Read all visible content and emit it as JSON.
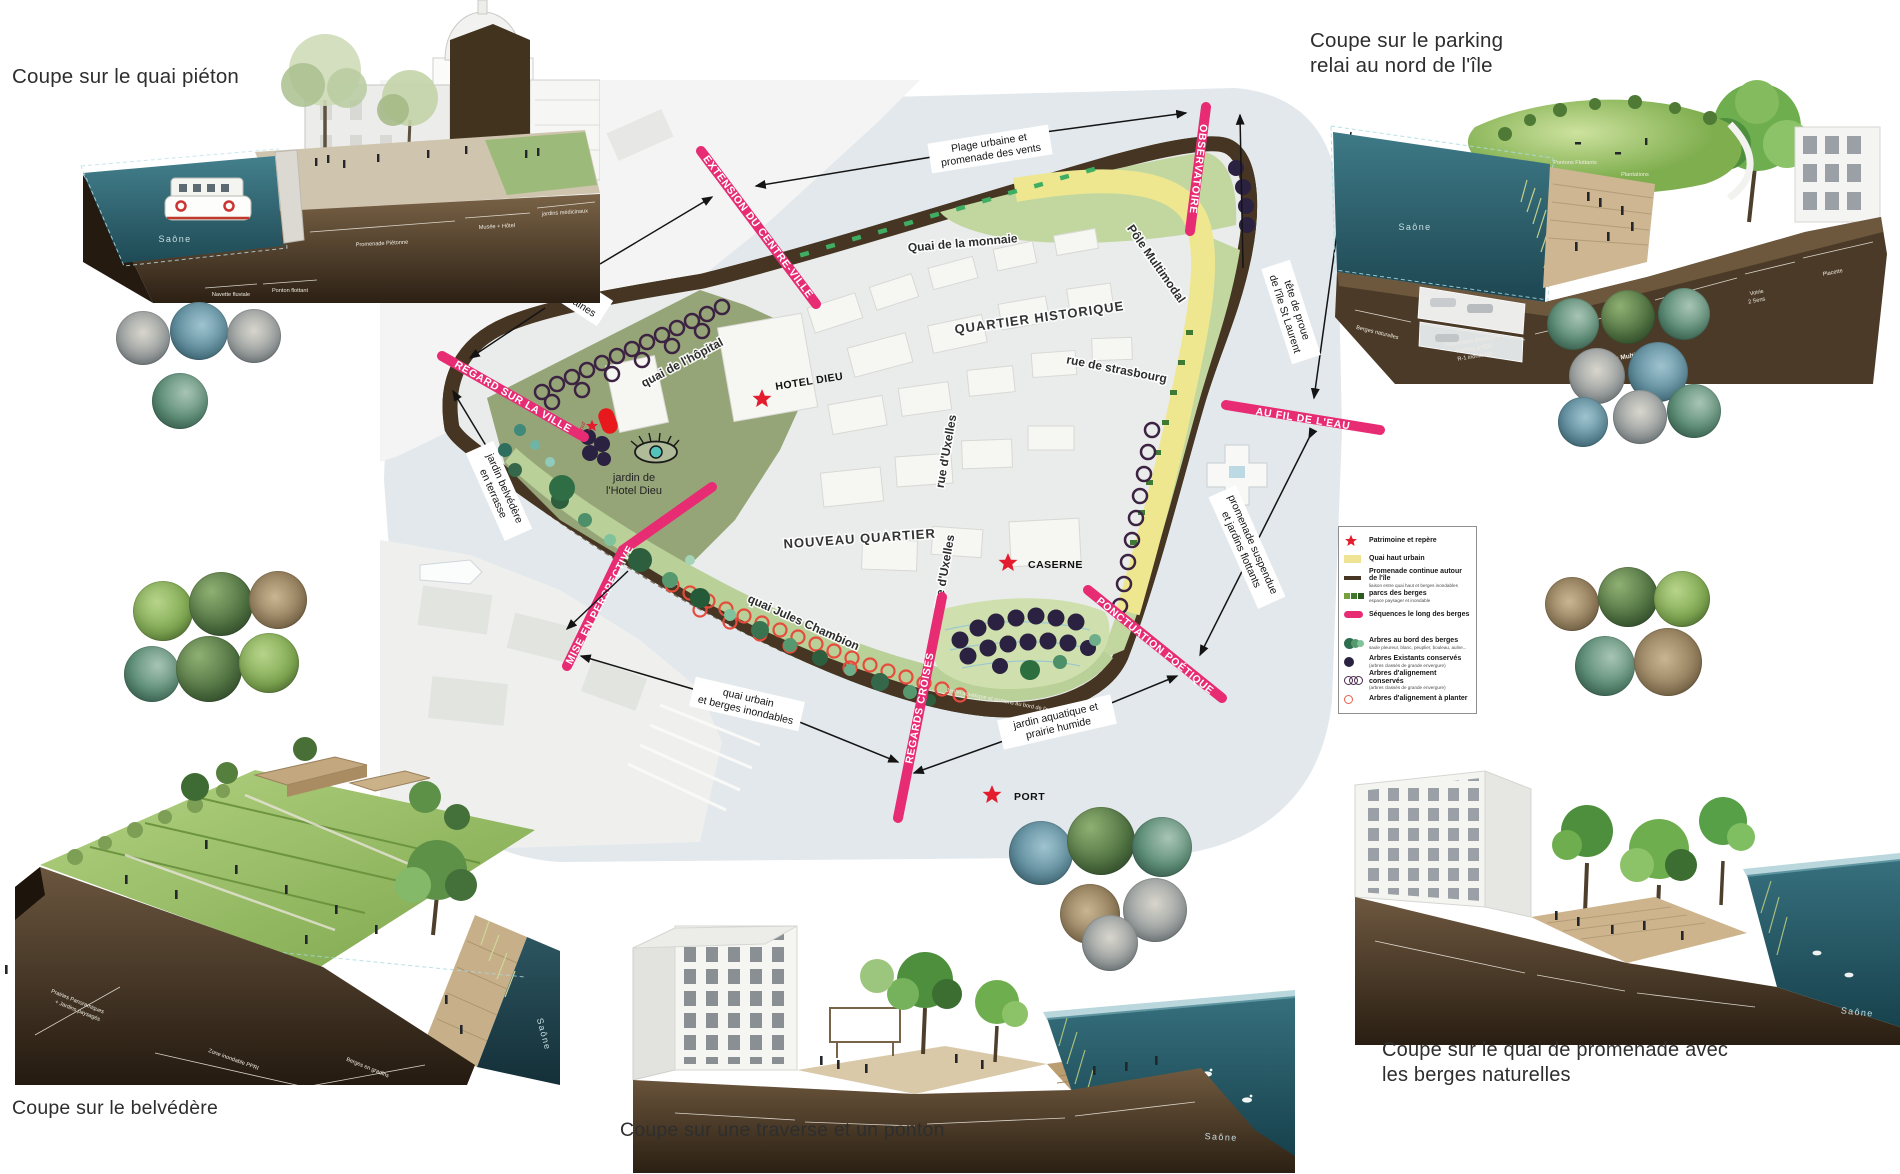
{
  "colors": {
    "accent_pink": "#e72c74",
    "quai_yellow": "#efe78f",
    "promenade_brown": "#453522",
    "park_green": "#b9d098",
    "tree_dark": "#2b2140",
    "tree_green": "#2f6e45",
    "star_red": "#e31c2e",
    "water_plan": "#e3e9ed",
    "water_render": "#2f6b78",
    "soil_brown": "#5a4632"
  },
  "titles": {
    "top_left": "Coupe sur le quai piéton",
    "top_right_line1": "Coupe sur le parking",
    "top_right_line2": "relai au nord de l'île",
    "bottom_left": "Coupe sur le belvédère",
    "bottom_center": "Coupe sur une traverse et un ponton",
    "bottom_right_line1": "Coupe sur le quai de promenade avec",
    "bottom_right_line2": "les berges naturelles"
  },
  "plan": {
    "streets": {
      "quai_monnaie": "Quai de la monnaie",
      "quai_hopital": "quai de l'hôpital",
      "rue_strasbourg": "rue de strasbourg",
      "quai_chambion": "quai Jules Chambion",
      "rue_uxelles": "rue d'Uxelles",
      "pole_multimodal": "Pôle Multimodal"
    },
    "districts": {
      "quartier_historique": "QUARTIER HISTORIQUE",
      "nouveau_quartier": "NOUVEAU QUARTIER",
      "jardin_line1": "jardin de",
      "jardin_line2": "l'Hotel Dieu"
    },
    "pois": {
      "hotel_dieu": "HOTEL DIEU",
      "caserne": "CASERNE",
      "port": "PORT",
      "tour": "tour"
    },
    "sequences": {
      "observatoire": "OBSERVATOIRE",
      "extension": "EXTENSION DU CENTRE-VILLE",
      "regard": "REGARD SUR LA VILLE",
      "mise": "MISE EN PERSPECTIVE",
      "regards_croises": "REGARDS CROISÉS",
      "ponctuation": "PONCTUATION POÉTIQUE",
      "au_fil": "AU FIL DE L'EAU"
    },
    "annotations": {
      "plage": [
        "Plage urbaine et",
        "promenade des vents"
      ],
      "quai_pierre": [
        "Quai de pierre",
        "& terrasses urbaines"
      ],
      "jardin_belvedere": [
        "jardin belvédère",
        "en terrasse"
      ],
      "quai_urbain": [
        "quai urbain",
        "et berges inondables"
      ],
      "jardin_aquatique": [
        "jardin aquatique et",
        "prairie humide"
      ],
      "promenade_suspendue": [
        "promenade suspendue",
        "et jardins flottants"
      ],
      "tete_proue": [
        "tête de proue",
        "de l'île St Laurent"
      ]
    },
    "band_note": "Jardin aquatique et pontons au bord de l'eau"
  },
  "legend": {
    "items": [
      {
        "label": "Patrimoine et repère",
        "sub": ""
      },
      {
        "label": "Quai haut urbain",
        "sub": ""
      },
      {
        "label": "Promenade continue autour de l'île",
        "sub": "liaison entre quai haut et berges inondables"
      },
      {
        "label": "parcs des berges",
        "sub": "espace paysager et inondable"
      },
      {
        "label": "Séquences le long des berges",
        "sub": ""
      },
      {
        "label": "Arbres au bord des berges",
        "sub": "saule pleureur, blanc, peuplier, bouleau, aulne..."
      },
      {
        "label": "Arbres Existants conservés",
        "sub": "(arbres classés de grande envergure)"
      },
      {
        "label": "Arbres d'alignement conservés",
        "sub": "(arbres classés de grande envergure)"
      },
      {
        "label": "Arbres d'alignement à planter",
        "sub": ""
      }
    ]
  },
  "renderings": {
    "top_left": {
      "saone": "Saône",
      "promenade": "Promenade Piétonne",
      "musee": "Musée + Hôtel",
      "jardins": "jardins médicinaux",
      "navette": "Navette fluviale",
      "ponton": "Ponton flottant"
    },
    "top_right": {
      "saone": "Saône",
      "berges": "Berges naturelles",
      "pontons": "Pontons Flottants",
      "plantations": "Plantations",
      "parking_l1": "Promenade Belvédère +",
      "parking_l2": "Parking à RDC",
      "parking_l3": "R-1 inondable",
      "trottoir": "Trottoir",
      "voirie_l1": "Voirie",
      "voirie_l2": "2 Sens",
      "placette": "Placette",
      "pole": "Pôle Multimodal"
    },
    "bottom_left": {
      "saone": "Saône",
      "prairies_l1": "Prairies Panoramiques",
      "prairies_l2": "+ Jardins paysagés",
      "zone": "Zone inondable PPRI",
      "berges": "Berges en gradins"
    },
    "bottom_center": {
      "saone": "Saône"
    },
    "bottom_right": {
      "saone": "Saône"
    }
  }
}
